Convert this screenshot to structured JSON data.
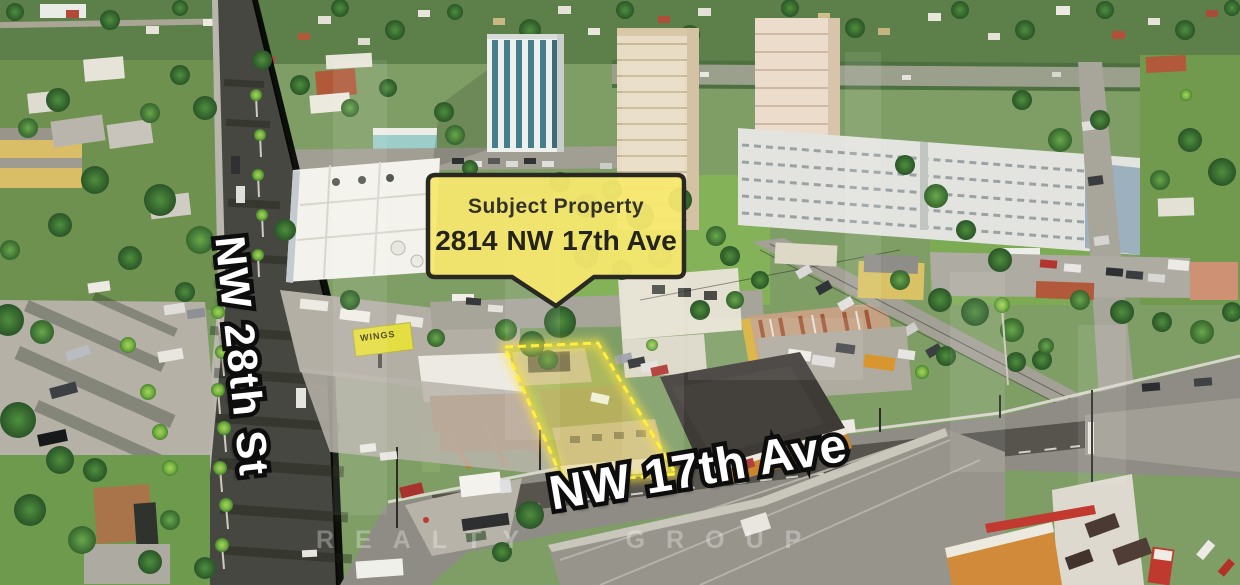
{
  "callout": {
    "title": "Subject Property",
    "address_number": "2814",
    "address_prefix": "NW",
    "address_street": "17th Ave"
  },
  "streets": {
    "cross_street": "NW 28th St",
    "main_avenue": "NW 17th Ave"
  },
  "watermark": {
    "text": "REALTY GROUP"
  },
  "billboard": {
    "text": "WINGS"
  },
  "colors": {
    "callout_fill": "#f6e76e",
    "callout_border": "#2a2822",
    "property_outline": "#ffee3e",
    "street_label_fill": "#ffffff",
    "street_label_stroke": "#0d0d0d"
  }
}
